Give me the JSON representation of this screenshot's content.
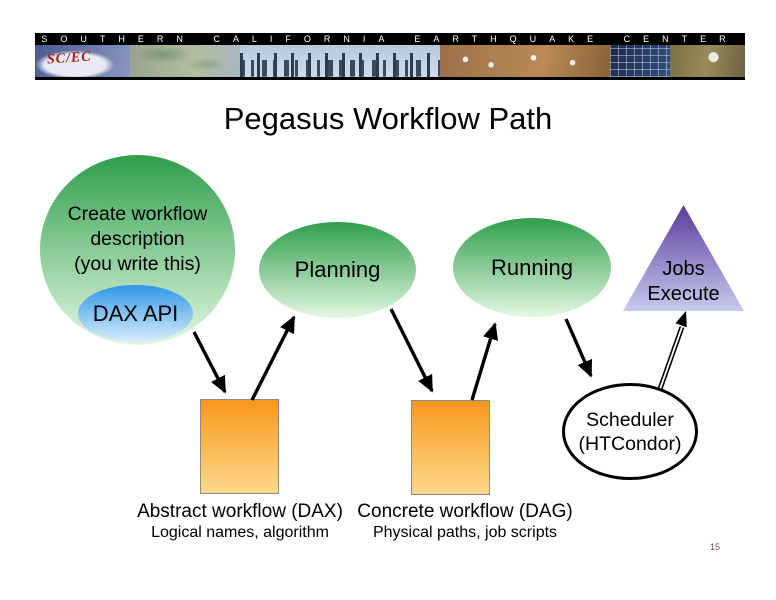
{
  "banner": {
    "strip_title": "SOUTHERN CALIFORNIA EARTHQUAKE CENTER",
    "logo_text": "SC/EC"
  },
  "slide": {
    "title": "Pegasus Workflow Path",
    "page_number": "15"
  },
  "diagram": {
    "nodes": {
      "create_workflow": {
        "label": "Create workflow\ndescription\n(you write this)"
      },
      "dax_api": {
        "label": "DAX API"
      },
      "planning": {
        "label": "Planning"
      },
      "running": {
        "label": "Running"
      },
      "jobs_execute": {
        "label": "Jobs\nExecute"
      },
      "scheduler": {
        "label": "Scheduler\n(HTCondor)"
      }
    },
    "captions": {
      "abstract": {
        "line1": "Abstract workflow (DAX)",
        "line2": "Logical names, algorithm"
      },
      "concrete": {
        "line1": "Concrete workflow (DAG)",
        "line2": "Physical paths, job scripts"
      }
    },
    "colors": {
      "green_top": "#2f9e4c",
      "green_bottom": "#e4f7e2",
      "blue_top": "#2f97e6",
      "blue_bottom": "#d8edfb",
      "orange_top": "#f7981c",
      "orange_bottom": "#fcd98c",
      "purple_top": "#5a3c9c",
      "purple_bottom": "#c7caee",
      "arrow_black": "#000000",
      "page_number_color": "#7a4545"
    }
  }
}
